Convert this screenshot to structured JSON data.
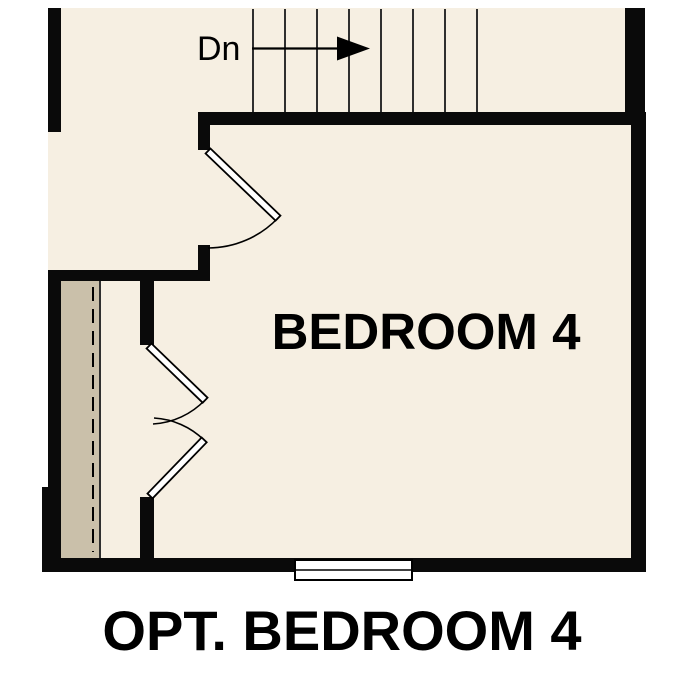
{
  "plan": {
    "caption": "OPT. BEDROOM 4",
    "room_label": "BEDROOM 4"
  },
  "stairs": {
    "direction_label": "Dn",
    "direction_icon": "right-arrow-icon",
    "tread_count": 8
  },
  "features": {
    "bedroom_door": "single-swing-door",
    "closet_doors": "double-swing-doors",
    "closet_rod": "dashed-rod-line",
    "window": "double-line-window"
  },
  "colors": {
    "outside": "#ffffff",
    "floor": "#f6efe2",
    "shelf": "#cac0aa",
    "wall": "#0a0a0a",
    "line": "#2f2f2f",
    "ink": "#000000"
  }
}
